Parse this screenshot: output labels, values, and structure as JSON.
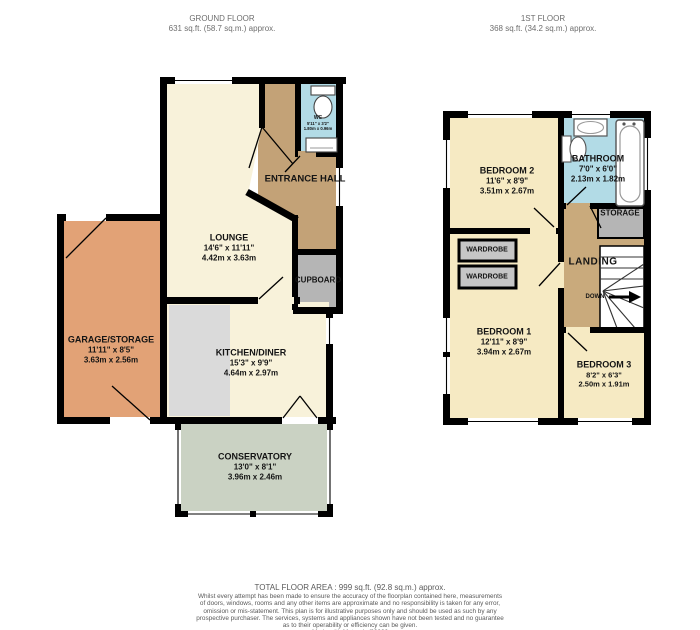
{
  "ground_floor": {
    "title": "GROUND FLOOR",
    "area": "631 sq.ft. (58.7 sq.m.) approx.",
    "rooms": {
      "lounge": {
        "name": "LOUNGE",
        "imperial": "14'6\" x 11'11\"",
        "metric": "4.42m x 3.63m"
      },
      "entrance_hall": {
        "name": "ENTRANCE HALL"
      },
      "wc": {
        "name": "WC",
        "imperial": "5'11\" x 3'2\"",
        "metric": "1.80m x 0.96m"
      },
      "cupboard": {
        "name": "CUPBOARD"
      },
      "garage_storage": {
        "name": "GARAGE/STORAGE",
        "imperial": "11'11\" x 8'5\"",
        "metric": "3.63m x 2.56m"
      },
      "kitchen_diner": {
        "name": "KITCHEN/DINER",
        "imperial": "15'3\" x 9'9\"",
        "metric": "4.64m x 2.97m"
      },
      "conservatory": {
        "name": "CONSERVATORY",
        "imperial": "13'0\" x 8'1\"",
        "metric": "3.96m x 2.46m"
      }
    }
  },
  "first_floor": {
    "title": "1ST FLOOR",
    "area": "368 sq.ft. (34.2 sq.m.) approx.",
    "rooms": {
      "bedroom2": {
        "name": "BEDROOM 2",
        "imperial": "11'6\" x 8'9\"",
        "metric": "3.51m x 2.67m"
      },
      "bathroom": {
        "name": "BATHROOM",
        "imperial": "7'0\" x 6'0\"",
        "metric": "2.13m x 1.82m"
      },
      "storage": {
        "name": "STORAGE"
      },
      "landing": {
        "name": "LANDING"
      },
      "stairs_direction": "DOWN",
      "wardrobe_a": {
        "name": "WARDROBE"
      },
      "wardrobe_b": {
        "name": "WARDROBE"
      },
      "bedroom1": {
        "name": "BEDROOM 1",
        "imperial": "12'11\" x 8'9\"",
        "metric": "3.94m x 2.67m"
      },
      "bedroom3": {
        "name": "BEDROOM 3",
        "imperial": "8'2\" x 6'3\"",
        "metric": "2.50m x 1.91m"
      }
    }
  },
  "footer": {
    "total_area": "TOTAL FLOOR AREA : 999 sq.ft. (92.8 sq.m.) approx.",
    "disclaimer": [
      "Whilst every attempt has been made to ensure the accuracy of the floorplan contained here, measurements",
      "of doors, windows, rooms and any other items are approximate and no responsibility is taken for any error,",
      "omission or mis-statement. This plan is for illustrative purposes only and should be used as such by any",
      "prospective purchaser. The services, systems and appliances shown have not been tested and no guarantee",
      "as to their operability or efficiency can be given.",
      "Made with Metropix ©2026"
    ]
  },
  "colors": {
    "wall": "#000000",
    "room_cream": "#f8f2da",
    "bedroom_cream": "#f6eac3",
    "hall_tan": "#c3a277",
    "landing_tan": "#c9aa7c",
    "bathroom_blue": "#b2dbe6",
    "garage_orange": "#e2a276",
    "conservatory_green": "#cad2c3",
    "storage_grey": "#b5b5b5",
    "wardrobe_grey": "#c6c6c6",
    "counter_grey": "#dadada"
  }
}
